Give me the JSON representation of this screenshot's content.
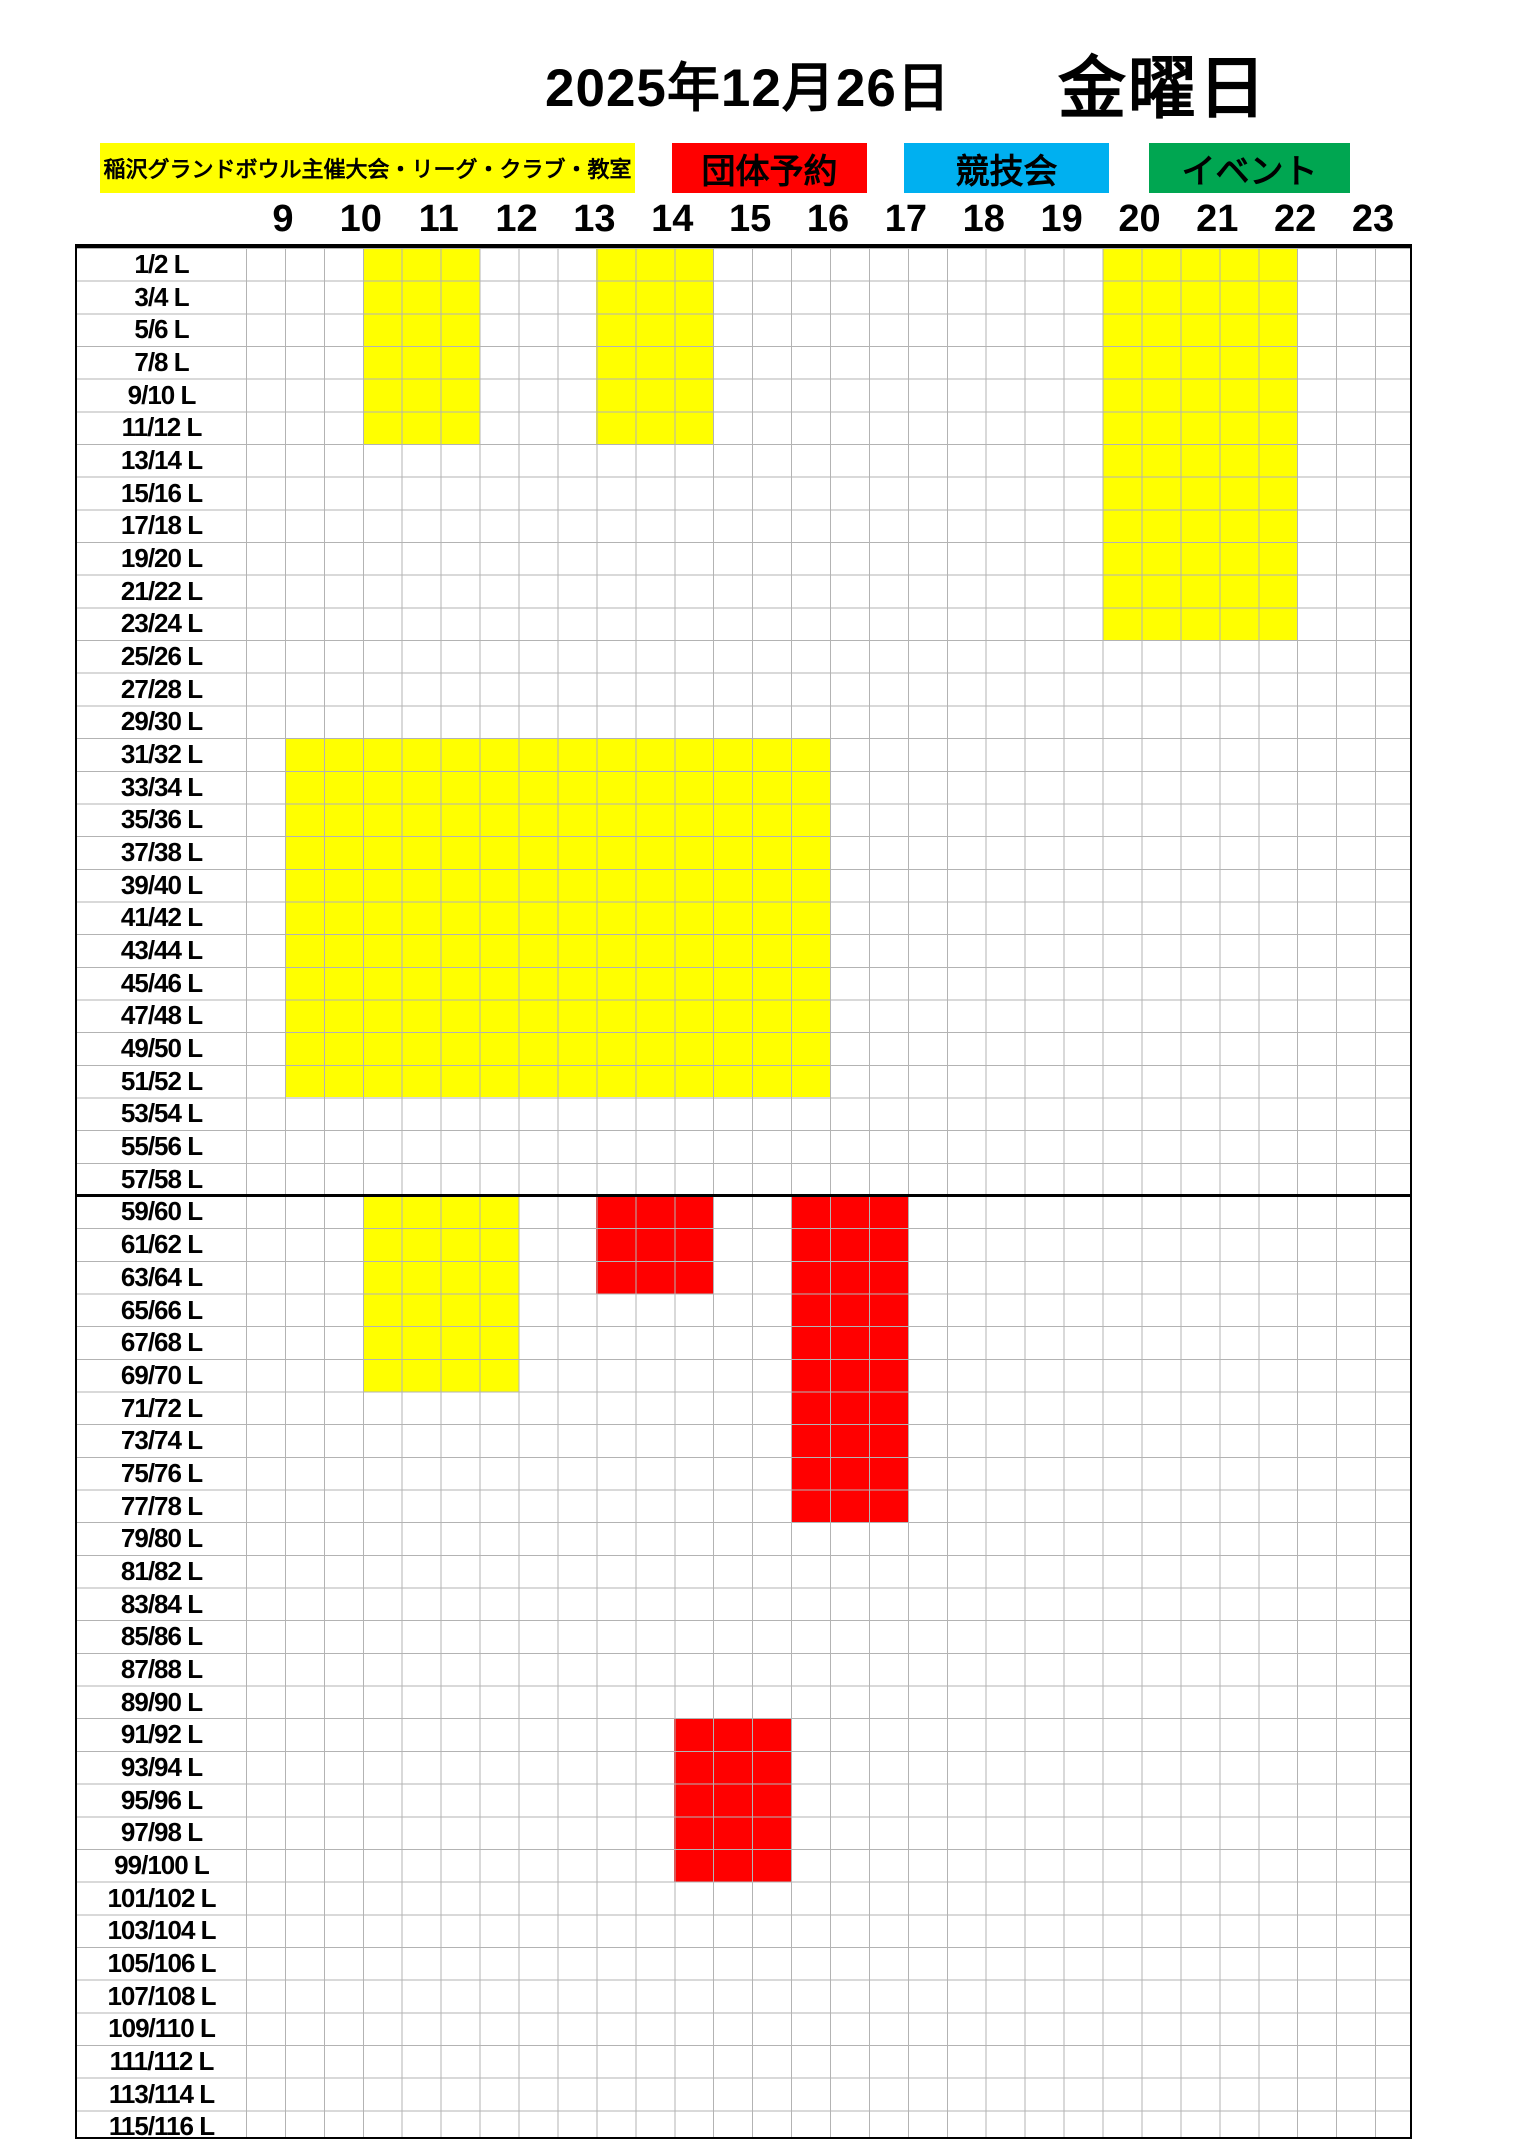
{
  "title": {
    "date": "2025年12月26日",
    "weekday": "金曜日"
  },
  "chart_data": {
    "type": "heatmap",
    "title": "2025年12月26日 金曜日 レーン予約表",
    "x_axis": {
      "hour_labels": [
        9,
        10,
        11,
        12,
        13,
        14,
        15,
        16,
        17,
        18,
        19,
        20,
        21,
        22,
        23
      ],
      "start_hour": 8.5,
      "end_hour": 23.5,
      "cell_minutes": 30
    },
    "y_axis": {
      "lanes": [
        "1/2 L",
        "3/4 L",
        "5/6 L",
        "7/8 L",
        "9/10 L",
        "11/12 L",
        "13/14 L",
        "15/16 L",
        "17/18 L",
        "19/20 L",
        "21/22 L",
        "23/24 L",
        "25/26 L",
        "27/28 L",
        "29/30 L",
        "31/32 L",
        "33/34 L",
        "35/36 L",
        "37/38 L",
        "39/40 L",
        "41/42 L",
        "43/44 L",
        "45/46 L",
        "47/48 L",
        "49/50 L",
        "51/52 L",
        "53/54 L",
        "55/56 L",
        "57/58 L",
        "59/60 L",
        "61/62 L",
        "63/64 L",
        "65/66 L",
        "67/68 L",
        "69/70 L",
        "71/72 L",
        "73/74 L",
        "75/76 L",
        "77/78 L",
        "79/80 L",
        "81/82 L",
        "83/84 L",
        "85/86 L",
        "87/88 L",
        "89/90 L",
        "91/92 L",
        "93/94 L",
        "95/96 L",
        "97/98 L",
        "99/100 L",
        "101/102 L",
        "103/104 L",
        "105/106 L",
        "107/108 L",
        "109/110 L",
        "111/112 L",
        "113/114 L",
        "115/116 L"
      ]
    },
    "legend": [
      {
        "id": "league",
        "label": "稲沢グランドボウル主催大会・リーグ・クラブ・教室",
        "color": "#ffff00"
      },
      {
        "id": "group",
        "label": "団体予約",
        "color": "#ff0000"
      },
      {
        "id": "competition",
        "label": "競技会",
        "color": "#00b0f0"
      },
      {
        "id": "event",
        "label": "イベント",
        "color": "#00a651"
      }
    ],
    "blocks": [
      {
        "category": "league",
        "lanes": "1/2 L - 11/12 L",
        "row_start": 0,
        "row_end": 5,
        "time": "10:00-11:30",
        "t_start": 10.0,
        "t_end": 11.5
      },
      {
        "category": "league",
        "lanes": "1/2 L - 11/12 L",
        "row_start": 0,
        "row_end": 5,
        "time": "13:00-14:30",
        "t_start": 13.0,
        "t_end": 14.5
      },
      {
        "category": "league",
        "lanes": "1/2 L - 23/24 L",
        "row_start": 0,
        "row_end": 11,
        "time": "19:30-22:00",
        "t_start": 19.5,
        "t_end": 22.0
      },
      {
        "category": "league",
        "lanes": "31/32 L - 51/52 L",
        "row_start": 15,
        "row_end": 25,
        "time": "9:00-16:00",
        "t_start": 9.0,
        "t_end": 16.0
      },
      {
        "category": "league",
        "lanes": "59/60 L - 69/70 L",
        "row_start": 29,
        "row_end": 34,
        "time": "10:00-12:00",
        "t_start": 10.0,
        "t_end": 12.0
      },
      {
        "category": "group",
        "lanes": "59/60 L - 63/64 L",
        "row_start": 29,
        "row_end": 31,
        "time": "13:00-14:30",
        "t_start": 13.0,
        "t_end": 14.5
      },
      {
        "category": "group",
        "lanes": "59/60 L - 77/78 L",
        "row_start": 29,
        "row_end": 38,
        "time": "15:30-17:00",
        "t_start": 15.5,
        "t_end": 17.0
      },
      {
        "category": "group",
        "lanes": "91/92 L - 99/100 L",
        "row_start": 45,
        "row_end": 49,
        "time": "14:00-15:30",
        "t_start": 14.0,
        "t_end": 15.5
      }
    ],
    "layout": {
      "separator_after_lane": "57/58 L",
      "grid_on": true,
      "legend_position": "top"
    }
  },
  "colors": {
    "grid_line": "#b3b3b3",
    "border": "#000000",
    "background": "#ffffff"
  }
}
